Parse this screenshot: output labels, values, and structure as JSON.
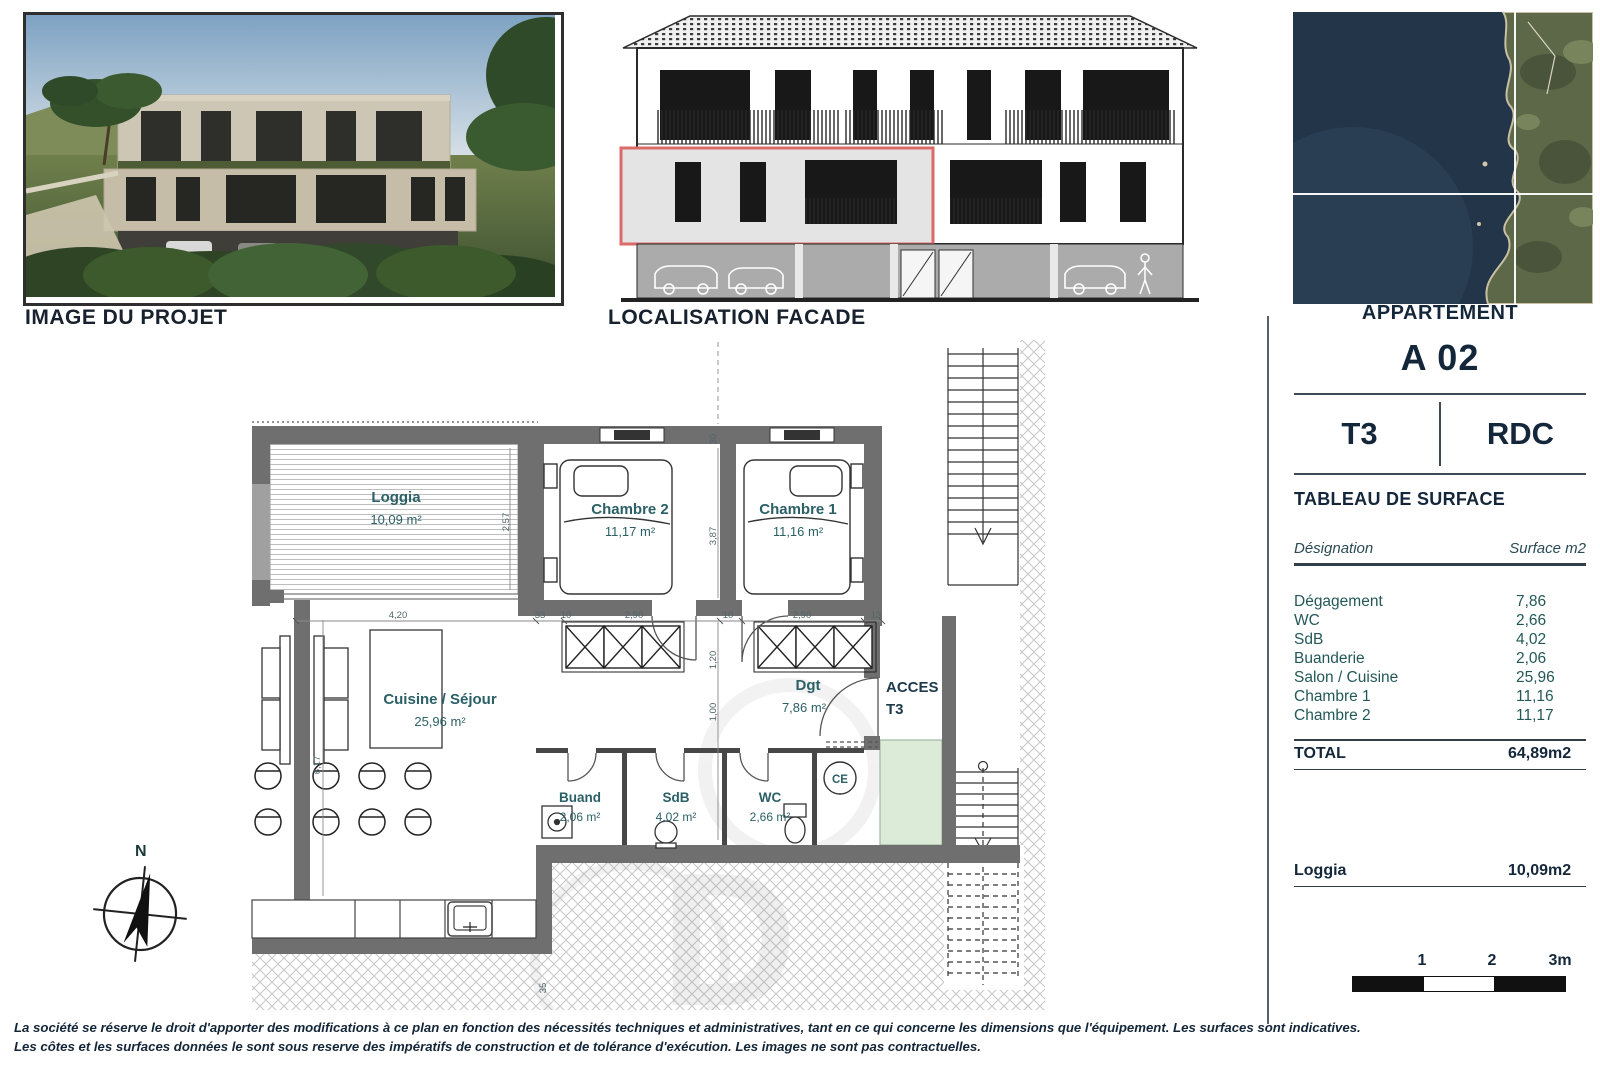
{
  "page": {
    "project_image_label": "IMAGE DU PROJET",
    "facade_label": "LOCALISATION FACADE",
    "map_label": "APPARTEMENT"
  },
  "apartment": {
    "code": "A 02",
    "type": "T3",
    "floor": "RDC",
    "table_title": "TABLEAU DE SURFACE"
  },
  "surface_table": {
    "col_designation": "Désignation",
    "col_surface": "Surface m2",
    "rows": [
      {
        "label": "Dégagement",
        "value": "7,86"
      },
      {
        "label": "WC",
        "value": "2,66"
      },
      {
        "label": "SdB",
        "value": "4,02"
      },
      {
        "label": "Buanderie",
        "value": "2,06"
      },
      {
        "label": "Salon / Cuisine",
        "value": "25,96"
      },
      {
        "label": "Chambre 1",
        "value": "11,16"
      },
      {
        "label": "Chambre 2",
        "value": "11,17"
      }
    ],
    "total_label": "TOTAL",
    "total_value": "64,89m2",
    "loggia_label": "Loggia",
    "loggia_value": "10,09m2"
  },
  "plan": {
    "rooms": {
      "loggia_name": "Loggia",
      "loggia_area": "10,09 m²",
      "chambre2_name": "Chambre 2",
      "chambre2_area": "11,17 m²",
      "chambre1_name": "Chambre 1",
      "chambre1_area": "11,16 m²",
      "cuisine_name": "Cuisine / Séjour",
      "cuisine_area": "25,96 m²",
      "buanderie_name": "Buand",
      "buanderie_area": "2,06 m²",
      "sdb_name": "SdB",
      "sdb_area": "4,02 m²",
      "wc_name": "WC",
      "wc_area": "2,66 m²",
      "dgt_name": "Dgt",
      "dgt_area": "7,86 m²",
      "acces_line1": "ACCES",
      "acces_line2": "T3",
      "ce_label": "CE"
    },
    "dims": {
      "loggia_h": "2,57",
      "cuisine_w": "4,20",
      "cuisine_h": "6,17",
      "d33": "33",
      "d10a": "10",
      "chambre2_w": "2,90",
      "d10b": "10",
      "chambre1_w": "2,90",
      "d13": "13",
      "d30": "30",
      "chambre_h": "3,87",
      "d120": "1,20",
      "d100": "1,00",
      "d35": "35"
    },
    "compass_label": "N"
  },
  "scale_bar": {
    "tick1": "1",
    "tick2": "2",
    "tick3": "3m"
  },
  "disclaimer": {
    "line1": "La société se réserve le droit d'apporter des modifications à ce plan en fonction des nécessités techniques et administratives, tant en ce qui concerne les dimensions que l'équipement. Les surfaces sont indicatives.",
    "line2": "Les côtes et les surfaces données le sont sous reserve des impératifs de construction et de tolérance d'exécution. Les images ne sont pas contractuelles."
  },
  "colors": {
    "wall_gray": "#6f6f6f",
    "highlight_red": "#dc6a6a",
    "access_green": "#dcead8",
    "label_teal": "#2a6066",
    "heading_navy": "#16283c"
  }
}
